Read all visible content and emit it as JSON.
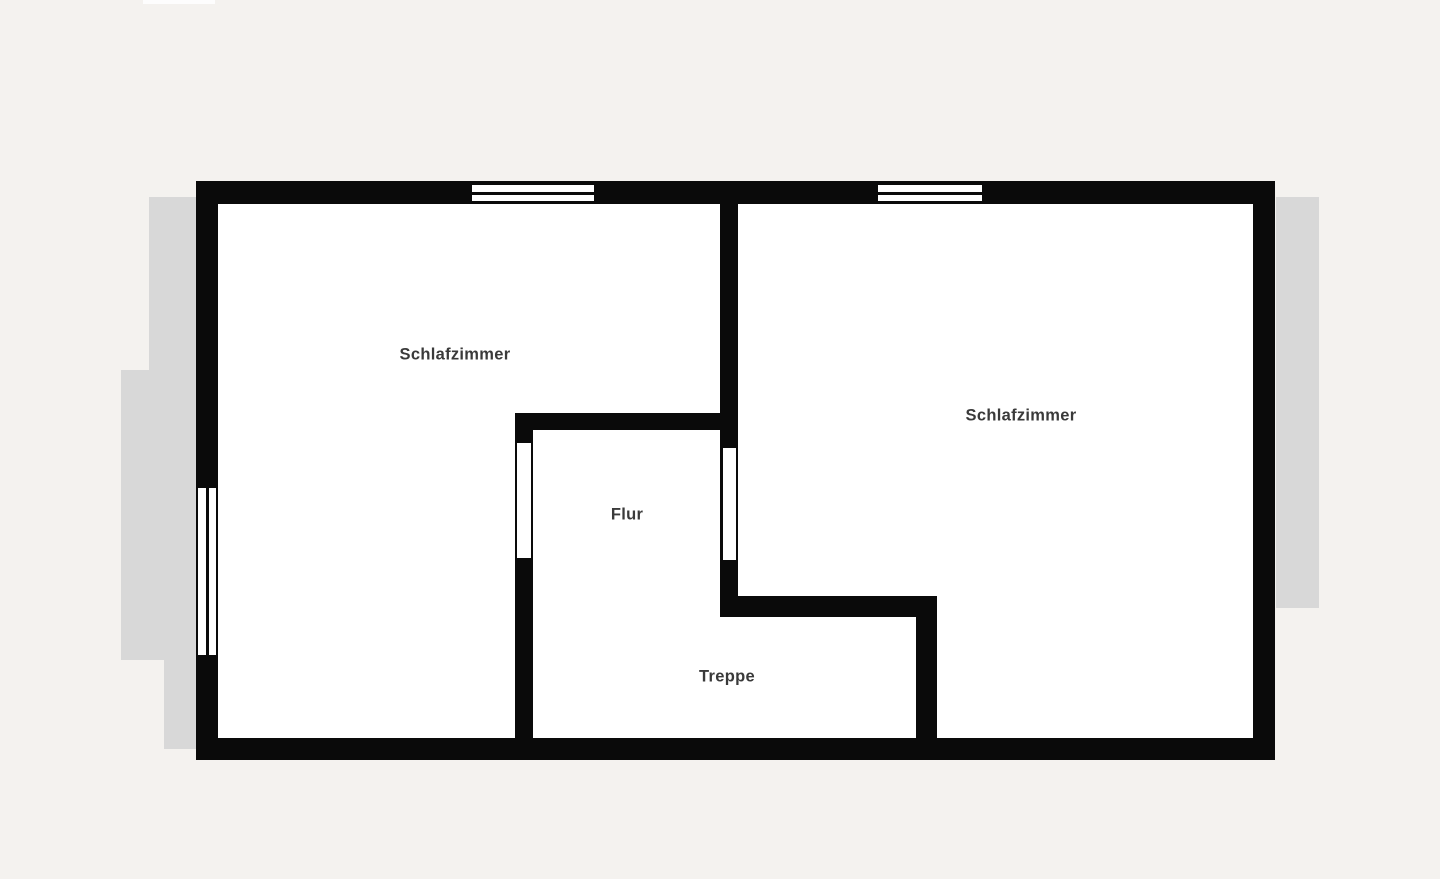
{
  "page": {
    "background": "#f4f2ef"
  },
  "colors": {
    "wall": "#0a0a0a",
    "floor": "#ffffff",
    "window_white": "#ffffff",
    "roof_overhang": "#d8d8d8",
    "label_text": "#3a3a3a",
    "top_strip": "#fdfdfd"
  },
  "plan": {
    "rooms": [
      {
        "name": "bedroom-left",
        "label": "Schlafzimmer"
      },
      {
        "name": "bedroom-right",
        "label": "Schlafzimmer"
      },
      {
        "name": "hallway",
        "label": "Flur"
      },
      {
        "name": "stairs",
        "label": "Treppe"
      }
    ],
    "geometry": {
      "overhangs": [
        {
          "name": "roof-overhang-left-upper",
          "x": 149,
          "y": 197,
          "w": 47,
          "h": 174
        },
        {
          "name": "roof-overhang-left-mid",
          "x": 121,
          "y": 370,
          "w": 75,
          "h": 290
        },
        {
          "name": "roof-overhang-left-lower",
          "x": 164,
          "y": 660,
          "w": 32,
          "h": 89
        },
        {
          "name": "roof-overhang-right",
          "x": 1276,
          "y": 197,
          "w": 43,
          "h": 411
        }
      ],
      "artifacts": [
        {
          "name": "top-white-strip",
          "x": 143,
          "y": 0,
          "w": 72,
          "h": 4
        }
      ],
      "floor": [
        {
          "name": "floor-area",
          "x": 196,
          "y": 181,
          "w": 1079,
          "h": 579
        }
      ],
      "walls": [
        {
          "name": "top-wall",
          "x": 196,
          "y": 181,
          "w": 1079,
          "h": 23
        },
        {
          "name": "bottom-wall",
          "x": 196,
          "y": 738,
          "w": 1079,
          "h": 22
        },
        {
          "name": "left-wall",
          "x": 196,
          "y": 181,
          "w": 22,
          "h": 579
        },
        {
          "name": "right-wall",
          "x": 1253,
          "y": 181,
          "w": 22,
          "h": 579
        },
        {
          "name": "bedroom-divider-wall",
          "x": 720,
          "y": 204,
          "w": 18,
          "h": 413
        },
        {
          "name": "hallway-top-wall",
          "x": 515,
          "y": 413,
          "w": 223,
          "h": 17
        },
        {
          "name": "hallway-left-wall",
          "x": 515,
          "y": 413,
          "w": 18,
          "h": 347
        },
        {
          "name": "stairs-top-wall",
          "x": 720,
          "y": 596,
          "w": 217,
          "h": 21
        },
        {
          "name": "stairs-right-wall",
          "x": 916,
          "y": 596,
          "w": 21,
          "h": 161
        }
      ],
      "window_glass": [
        {
          "name": "top-window-left-glass",
          "x": 472,
          "y": 185,
          "w": 122,
          "h": 16
        },
        {
          "name": "top-window-right-glass",
          "x": 878,
          "y": 185,
          "w": 104,
          "h": 16
        },
        {
          "name": "left-window-glass",
          "x": 198,
          "y": 488,
          "w": 18,
          "h": 167
        },
        {
          "name": "hallway-left-opening",
          "x": 517,
          "y": 443,
          "w": 14,
          "h": 115
        },
        {
          "name": "hallway-right-opening",
          "x": 723,
          "y": 448,
          "w": 13,
          "h": 112
        }
      ],
      "window_dividers": [
        {
          "name": "top-window-left-divider",
          "x": 472,
          "y": 192,
          "w": 122,
          "h": 3
        },
        {
          "name": "top-window-right-divider",
          "x": 878,
          "y": 192,
          "w": 104,
          "h": 3
        },
        {
          "name": "left-window-divider",
          "x": 206,
          "y": 488,
          "w": 3,
          "h": 167
        }
      ]
    }
  }
}
